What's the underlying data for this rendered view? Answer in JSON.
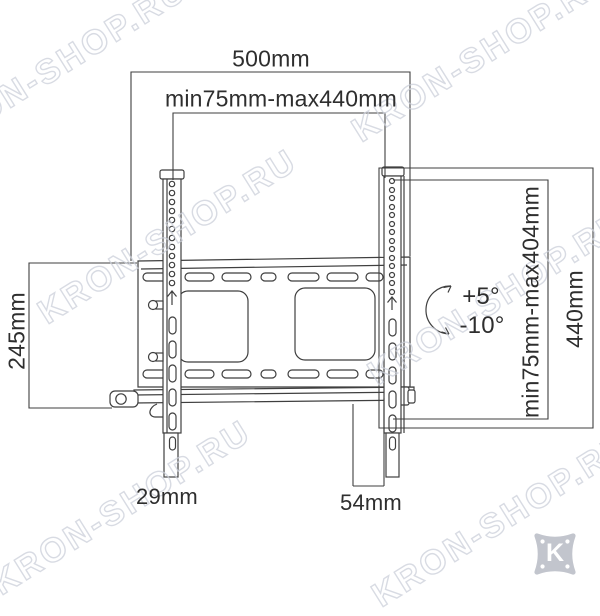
{
  "watermark": {
    "text": "KRON-SHOP.RU"
  },
  "brand_logo": {
    "letter": "K"
  },
  "dimensions": {
    "total_width": "500mm",
    "vesa_width_range": "min75mm-max440mm",
    "plate_height": "245mm",
    "vesa_height_range": "min75mm-max404mm",
    "bracket_height": "440mm",
    "tilt_up": "+5°",
    "tilt_down": "-10°",
    "min_depth": "29mm",
    "max_depth": "54mm"
  },
  "colors": {
    "line": "#3f3f3f",
    "text": "#2e2e2e",
    "watermark_outline": "#ccd0da",
    "logo_gray": "#c2c5cd"
  }
}
